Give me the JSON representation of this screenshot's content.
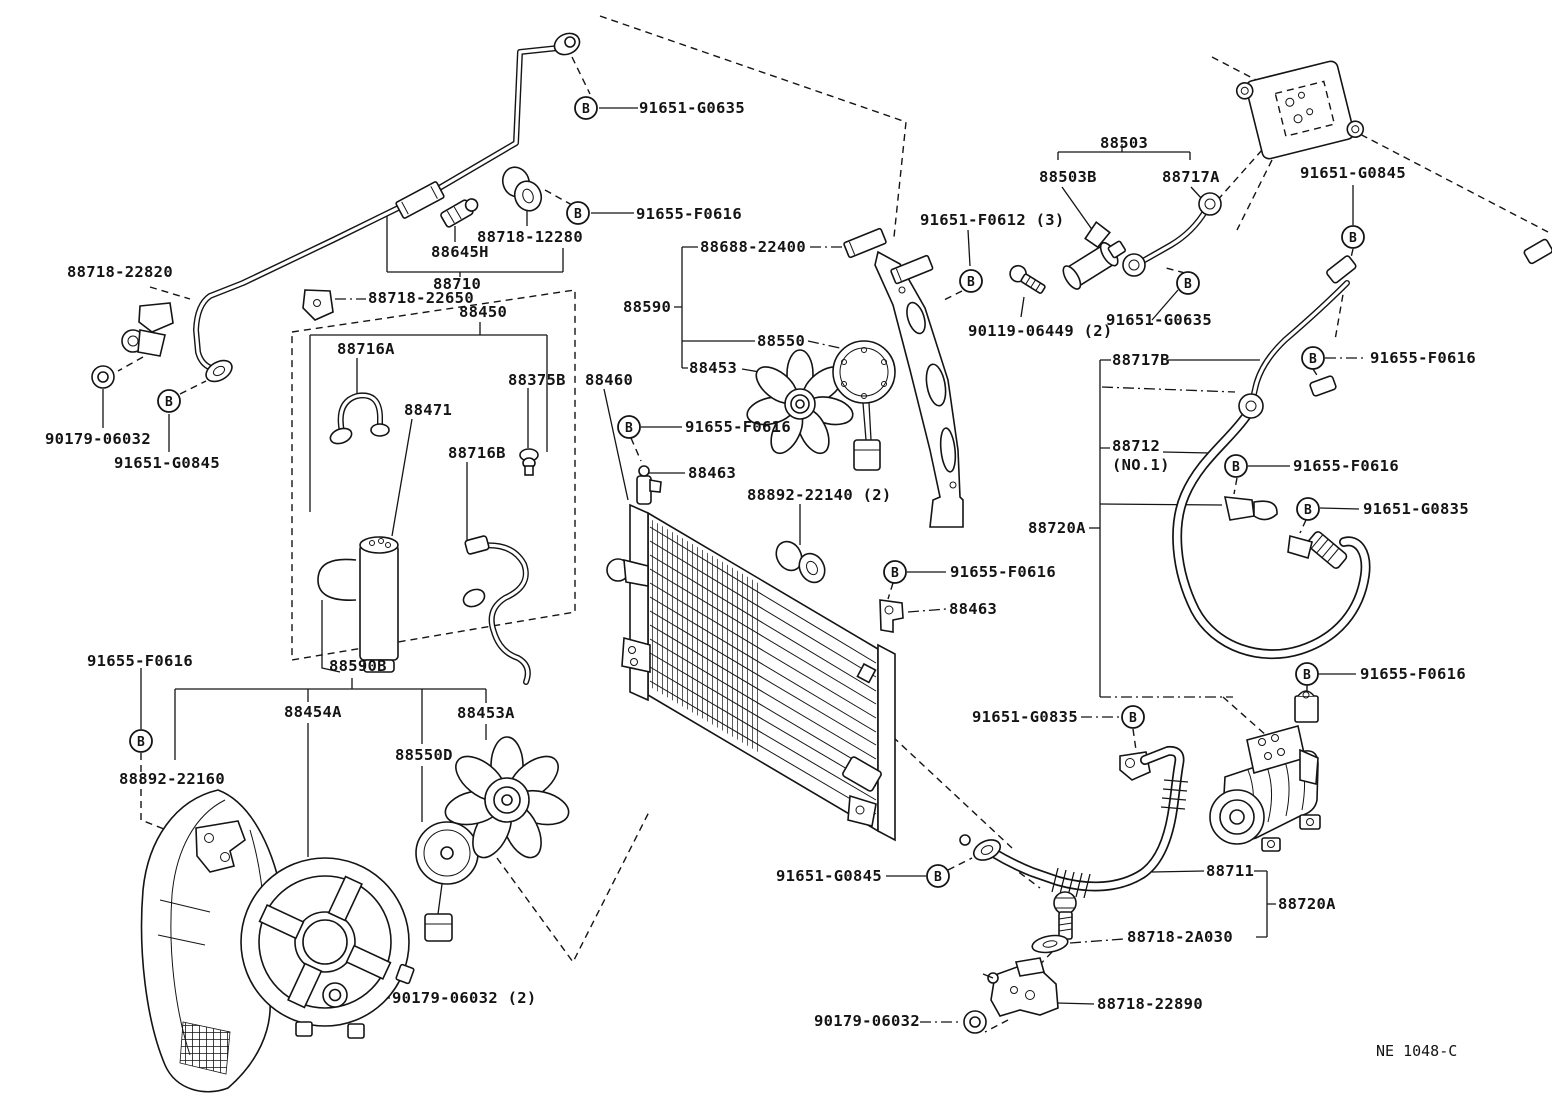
{
  "colors": {
    "ink": "#141414",
    "background": "#ffffff"
  },
  "bolt_symbol": "B",
  "drawing_number": "NE 1048-C",
  "labels": [
    {
      "text": "91651-G0635"
    },
    {
      "text": "91655-F0616"
    },
    {
      "text": "88718-12280"
    },
    {
      "text": "88645H"
    },
    {
      "text": "88710"
    },
    {
      "text": "88718-22650"
    },
    {
      "text": "88450"
    },
    {
      "text": "88718-22820"
    },
    {
      "text": "88716A"
    },
    {
      "text": "88590"
    },
    {
      "text": "88688-22400"
    },
    {
      "text": "88550"
    },
    {
      "text": "88453"
    },
    {
      "text": "91651-F0612 (3)"
    },
    {
      "text": "88503"
    },
    {
      "text": "88503B"
    },
    {
      "text": "88717A"
    },
    {
      "text": "91651-G0845"
    },
    {
      "text": "90119-06449 (2)"
    },
    {
      "text": "91651-G0635"
    },
    {
      "text": "88717B"
    },
    {
      "text": "91655-F0616"
    },
    {
      "text": "88712"
    },
    {
      "text": "(NO.1)"
    },
    {
      "text": "91655-F0616"
    },
    {
      "text": "91651-G0835"
    },
    {
      "text": "88720A"
    },
    {
      "text": "88460"
    },
    {
      "text": "88375B"
    },
    {
      "text": "88471"
    },
    {
      "text": "88716B"
    },
    {
      "text": "90179-06032"
    },
    {
      "text": "91651-G0845"
    },
    {
      "text": "91655-F0616"
    },
    {
      "text": "88463"
    },
    {
      "text": "88892-22140 (2)"
    },
    {
      "text": "91655-F0616"
    },
    {
      "text": "88463"
    },
    {
      "text": "91655-F0616"
    },
    {
      "text": "88590B"
    },
    {
      "text": "88454A"
    },
    {
      "text": "88453A"
    },
    {
      "text": "88892-22160"
    },
    {
      "text": "88550D"
    },
    {
      "text": "91651-G0835"
    },
    {
      "text": "91655-F0616"
    },
    {
      "text": "91651-G0845"
    },
    {
      "text": "88711"
    },
    {
      "text": "88720A"
    },
    {
      "text": "88718-2A030"
    },
    {
      "text": "88718-22890"
    },
    {
      "text": "90179-06032"
    },
    {
      "text": "90179-06032 (2)"
    }
  ]
}
